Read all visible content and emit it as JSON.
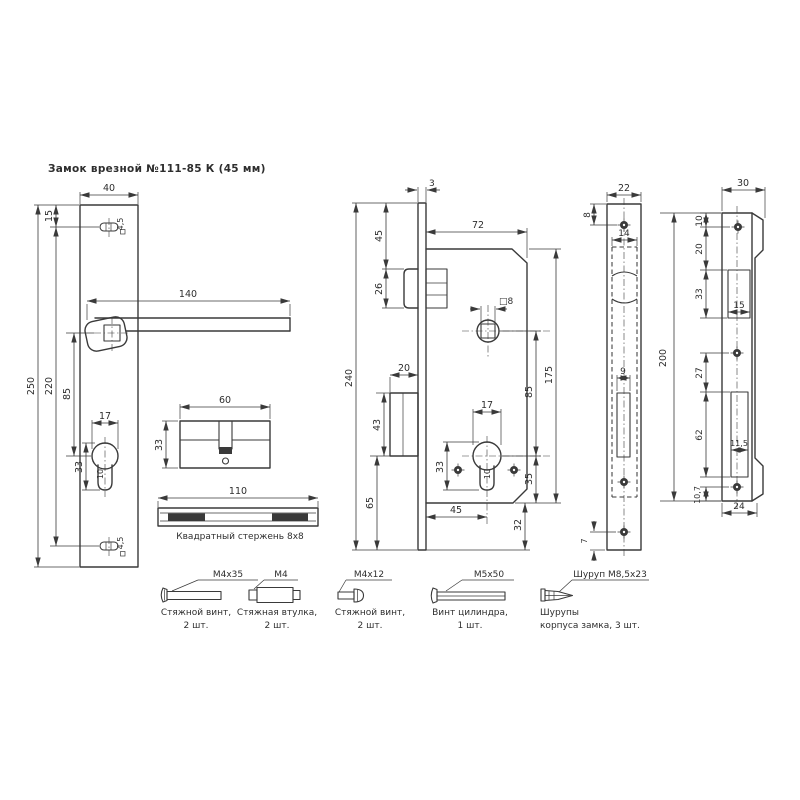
{
  "title": "Замок врезной №111-85 К (45 мм)",
  "colors": {
    "line": "#3a3a3a",
    "bg": "#ffffff"
  },
  "handle_plate": {
    "w": "40",
    "h": "250",
    "d220": "220",
    "d85": "85",
    "d15": "15",
    "handle_len": "140",
    "key_w": "17",
    "key_h": "33",
    "key_d": "10",
    "hole_top": "4,5",
    "hole_bot": "4,5"
  },
  "cylinder": {
    "len": "60",
    "h": "33"
  },
  "rod": {
    "len": "110",
    "label": "Квадратный стержень 8х8"
  },
  "lock_body": {
    "total_h": "240",
    "face_t": "3",
    "top": "45",
    "latch_h": "26",
    "bolt_w": "20",
    "bolt_h": "43",
    "bottom": "65",
    "body_w": "72",
    "square_hole": "□8",
    "centers": "85",
    "body_h": "175",
    "cyl_w": "17",
    "cyl_h": "33",
    "cyl_d": "10",
    "backset": "45",
    "below_cyl": "35",
    "below_body": "32"
  },
  "faceplate": {
    "w": "22",
    "top_screw": "8",
    "slot_w": "14",
    "bolt_slot": "9",
    "bottom_screw": "7",
    "h": "200"
  },
  "strike": {
    "w": "30",
    "d10": "10",
    "d20": "20",
    "d33": "33",
    "d15": "15",
    "d27": "27",
    "d62": "62",
    "d115": "11,5",
    "d107": "10,7",
    "d24": "24"
  },
  "fasteners": [
    {
      "spec": "М4х35",
      "line1": "Стяжной винт,",
      "line2": "2 шт."
    },
    {
      "spec": "М4",
      "line1": "Стяжная втулка,",
      "line2": "2 шт."
    },
    {
      "spec": "М4х12",
      "line1": "Стяжной винт,",
      "line2": "2 шт."
    },
    {
      "spec": "М5х50",
      "line1": "Винт цилиндра,",
      "line2": "1 шт."
    },
    {
      "spec": "Шуруп М8,5х23",
      "line1": "Шурупы",
      "line2": "корпуса замка, 3 шт."
    }
  ]
}
